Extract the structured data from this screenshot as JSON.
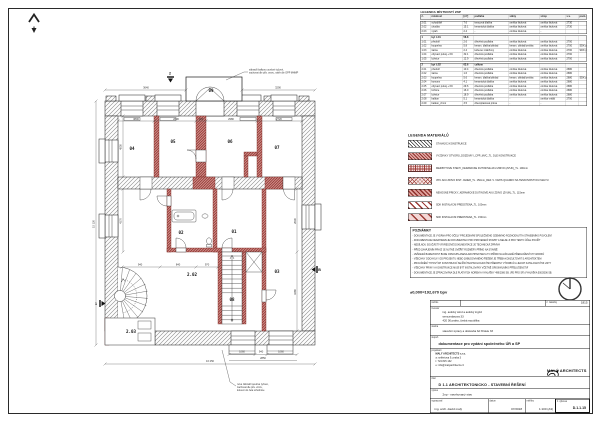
{
  "colors": {
    "accent_red": "#9c3b36",
    "wall_gray": "#8a8a8a",
    "line": "#1a1a1a"
  },
  "room_table": {
    "title": "LEGENDA MÍSTNOSTÍ 2NP",
    "headers": [
      "č.",
      "místnost",
      "[m²]",
      "podlaha",
      "stěny",
      "strop",
      "s.v.",
      "pozn."
    ],
    "groups": [
      {
        "header": null,
        "rows": [
          [
            "2.01",
            "schodiště",
            "7.6",
            "teracová dlažba",
            "omítka štuková",
            "omítka štuková",
            "2730",
            ""
          ],
          [
            "2.02",
            "chodba",
            "15.1",
            "keramická dlažba",
            "omítka štuková",
            "omítka štuková",
            "2730",
            ""
          ],
          [
            "2.03",
            "výtah",
            "2.4",
            "-",
            "omítka štuková",
            "-",
            "",
            ""
          ]
        ]
      },
      {
        "header": [
          "1",
          "byt č.01",
          "58.8",
          "",
          "",
          "",
          "",
          ""
        ],
        "rows": [
          [
            "1.01",
            "předsíň",
            "2.6",
            "dřevěná podlaha",
            "omítka štuková",
            "omítka štuková",
            "2700",
            ""
          ],
          [
            "1.02",
            "koupelna",
            "5.8",
            "keram. dlažba/obklad",
            "keram. obklad/omítka",
            "omítka štuková",
            "2700",
            "SDK podhled"
          ],
          [
            "1.03",
            "šatna",
            "2.4",
            "koberec zátěžový",
            "omítka štuková",
            "omítka štuková",
            "2700",
            "SDK podhled"
          ],
          [
            "1.04",
            "obývací pokoj + KK",
            "32.1",
            "dřevěná podlaha",
            "omítka štuková",
            "omítka štuková",
            "2700",
            ""
          ],
          [
            "1.05",
            "ložnice",
            "12.9",
            "dřevěná podlaha",
            "omítka štuková",
            "omítka štuková",
            "2700",
            ""
          ]
        ]
      },
      {
        "header": [
          "2",
          "byt č.02",
          "63.6",
          "celkem",
          "",
          "",
          "",
          ""
        ],
        "rows": [
          [
            "2.01",
            "předsíň",
            "10.4",
            "dřevěná podlaha",
            "omítka štuková",
            "omítka štuková",
            "2680",
            ""
          ],
          [
            "2.02",
            "šatna",
            "1.6",
            "dřevěná podlaha",
            "omítka štuková",
            "omítka štuková",
            "2680",
            ""
          ],
          [
            "2.03",
            "koupelna",
            "5.6",
            "keram. dlažba/obklad",
            "keram. obklad/omítka",
            "omítka štuková",
            "2680",
            "SDK podhled"
          ],
          [
            "2.04",
            "komora",
            "4.1",
            "keramická dlažba",
            "omítka štuková",
            "omítka štuková",
            "2680",
            ""
          ],
          [
            "2.05",
            "obývací pokoj + KK",
            "29.6",
            "dřevěná podlaha",
            "omítka štuková",
            "omítka štuková",
            "2680",
            ""
          ],
          [
            "2.06",
            "ložnice",
            "16.0",
            "dřevěná podlaha",
            "omítka štuková",
            "omítka štuková",
            "2680",
            ""
          ],
          [
            "2.07",
            "ložnice",
            "18.9",
            "dřevěná podlaha",
            "omítka štuková",
            "omítka štuková",
            "2680",
            ""
          ],
          [
            "2.08",
            "balkon",
            "5.1",
            "keramická dlažba",
            "-",
            "omítka vnější",
            "2700",
            ""
          ],
          [
            "2.09",
            "balkon_zimní",
            "3.5",
            "dřevoplastová prkna",
            "-",
            "-",
            "",
            ""
          ]
        ]
      }
    ]
  },
  "materials": {
    "title": "LEGENDA MATERIÁLŮ",
    "items": [
      {
        "pattern": "p-black",
        "label": "STÁVAJÍCÍ KONSTRUKCE"
      },
      {
        "pattern": "p-red-diag",
        "label": "VYZDÍVKY OTVORŮ_DOZDÍVKY_CPP_MVC_TL. DLE KONSTRUKCE"
      },
      {
        "pattern": "p-red-grid",
        "label": "MEZIBYTOVÉ STĚNY_KERAMICKÉ DUTINOVÉ AKU ZDIVO (ZVUK)_TL. 190mm"
      },
      {
        "pattern": "p-red-grid2",
        "label": "VPC AKU ZDIVO INST. JADER_TL. 150mm_REF. V. VÁPIS QUADRO NA TENKOVRSTVOU MALTU"
      },
      {
        "pattern": "p-red-diag2",
        "label": "NENOSNÉ PŘÍČKY_KERAMICKÉ DUTINOVÉ AKU ZDIVO (ZVUK)_TL. 115mm"
      },
      {
        "pattern": "p-sdk1",
        "label": "SDK INSTALAČNÍ PŘEDSTĚNA_TL. 100mm"
      },
      {
        "pattern": "p-sdk2",
        "label": "SDK INSTALAČNÍ PŘEDSTĚNA_TL. 150mm"
      }
    ]
  },
  "notes": {
    "title": "POZNÁMKY",
    "lines": [
      "- DOKUMENTACE JE VYDÁNA PRO ÚČELY PROJEDNÁNÍ SPOLEČNÉHO ÚZEMNÍHO ROZHODNUTÍ A STAVEBNÍHO POVOLENÍ",
      "- DOKUMENTACE NENAHRAZUJE DOKUMENTACI PRO PROVEDENÍ STAVBY A NELZE JI PRO TENTO ÚČEL POUŽÍT",
      "- NEDÍLNOU SOUČÁSTÍ VÝKRESOVÉ DOKUMENTACE JE TECHNICKÁ ZPRÁVA",
      "- PŘED ZAHÁJENÍM PRACÍ JE NUTNÉ OVĚŘIT ROZMĚRY PŘÍMO NA STAVBĚ",
      "- VEŠKERÁ BAREVNOST BUDE ODSOUHLASENA ARCHITEKTEM A TO PŘÍMO NA ZÁKLADĚ PŘEDLOŽENÝCH VZORKŮ",
      "- VŠECHNY ODCHYLKY OD PROJEKTU NEBO ZABUDOVANÉHO ŘEŠENÍ JE TŘEBA KONZULTOVAT S ARCHITEKTEM",
      "- PROVÁDĚNÍ TYPOVÝCH KONSTRUKCÍ SE ŘÍDÍ TECHNOLOGICKÝMI PŘEDPISY VÝROBCŮ A JEJICH KATALOGOVÝMI LISTY",
      "- VŠECHNY PRVKY A KONSTRUKCE MUSÍ BÝT INSTALOVÁNY VČETNĚ ORIGINÁLNÍHO PŘÍSLUŠENSTVÍ",
      "- DOKUMENTACE JE ZPRACOVÁNA DLE PLATNÝCH NOREM A VYHLÁŠKY 499/2006 SB. (PD PRO SP) VYHLÁŠKA 500/2006 SB."
    ]
  },
  "datum_text": "±0,000=192,670 bpv",
  "titleblock": {
    "stamp_label": "razítko",
    "order_label": "č. zakázky",
    "order_value": "1815",
    "investor_label": "investor",
    "investor_lines": [
      "ing. autický wind a autický ingrid",
      "wenceslasova 33",
      "420 00 praha, česká republika"
    ],
    "stavba_label": "stavba",
    "stavba_value": "stavební úpravy a dostavba bd hřídele 33",
    "stupen_label": "stupeň",
    "stupen_value": "dokumentace pro vydání společného ÚR a SP",
    "projektant_label": "projektant",
    "projektant_lines": [
      "MALÝ ARCHITECTS s.r.o.",
      "a: seifertova 9, praha 3",
      "t: 724 815 132",
      "e: info@malyarchitects.cz"
    ],
    "logo_text": "MALÝ ARCHITECTS",
    "part_label": "část",
    "part_value": "D 1.1 ARCHITEKTONICKO - STAVEBNÍ ŘEŠENÍ",
    "drawing_label": "výkres",
    "drawing_value": "2np - navrhovaný stav",
    "author_label": "vypracoval",
    "author_value": "ing. arch. david malý",
    "date_label": "datum",
    "date_value": "07/2018",
    "scale_label": "měřítko",
    "scale_value": "1:100 (A3)",
    "number_label": "č. výkresu",
    "number_value": "D.1.1.15"
  },
  "plan": {
    "room_labels": [
      {
        "t": "04",
        "x": 132,
        "y": 150
      },
      {
        "t": "05",
        "x": 173,
        "y": 143
      },
      {
        "t": "06",
        "x": 230,
        "y": 143
      },
      {
        "t": "07",
        "x": 277,
        "y": 149
      },
      {
        "t": "09",
        "x": 211,
        "y": 92
      },
      {
        "t": "02",
        "x": 181,
        "y": 234
      },
      {
        "t": "01",
        "x": 234,
        "y": 233
      },
      {
        "t": "03",
        "x": 277,
        "y": 273
      },
      {
        "t": "08",
        "x": 232,
        "y": 301
      },
      {
        "t": "2.02",
        "x": 192,
        "y": 276
      },
      {
        "t": "2.03",
        "x": 131,
        "y": 333
      }
    ],
    "dims": [
      {
        "t": "3800",
        "x": 136,
        "y": 119.8
      },
      {
        "t": "2630",
        "x": 176,
        "y": 119.8
      },
      {
        "t": "300",
        "x": 201,
        "y": 119.8
      },
      {
        "t": "2980",
        "x": 231,
        "y": 119.8
      },
      {
        "t": "2720",
        "x": 279,
        "y": 119.8
      },
      {
        "t": "3640",
        "x": 146,
        "y": 88.5
      },
      {
        "t": "3290",
        "x": 278,
        "y": 88.5
      },
      {
        "t": "4530",
        "x": 121.5,
        "y": 147,
        "rot": -90
      },
      {
        "t": "4170",
        "x": 121.5,
        "y": 221,
        "rot": -90
      },
      {
        "t": "940",
        "x": 140,
        "y": 265.5
      },
      {
        "t": "840",
        "x": 178,
        "y": 265.5
      },
      {
        "t": "970",
        "x": 207,
        "y": 265.5
      },
      {
        "t": "2630",
        "x": 295.8,
        "y": 221,
        "rot": -90
      },
      {
        "t": "3280",
        "x": 295.8,
        "y": 292,
        "rot": -90
      },
      {
        "t": "1060",
        "x": 242,
        "y": 352.6
      },
      {
        "t": "940",
        "x": 261,
        "y": 352.6
      },
      {
        "t": "1060",
        "x": 281,
        "y": 352.6
      },
      {
        "t": "2850",
        "x": 263,
        "y": 358.8
      },
      {
        "t": "16 250",
        "x": 210,
        "y": 362.2
      },
      {
        "t": "15 120",
        "x": 94.5,
        "y": 224,
        "rot": -90
      }
    ],
    "annotations": [
      {
        "lines": [
          "zábradlí balkonu ocelové tyčové,",
          "zachovat dle pův. vzoru, nátěr dle OPP MHMP"
        ],
        "x": 249,
        "y": 70.5
      },
      {
        "lines": [
          "nové zábradlí ocelové tyčové,",
          "zachovat dle pův. vzoru,",
          "kotvení do čela schodnice"
        ],
        "x": 237,
        "y": 385
      }
    ],
    "section_marks": [
      {
        "t": "2",
        "x": 170,
        "y": 74.5
      },
      {
        "t": "1",
        "x": 96,
        "y": 305
      },
      {
        "t": "B",
        "x": 319.5,
        "y": 271
      }
    ]
  }
}
